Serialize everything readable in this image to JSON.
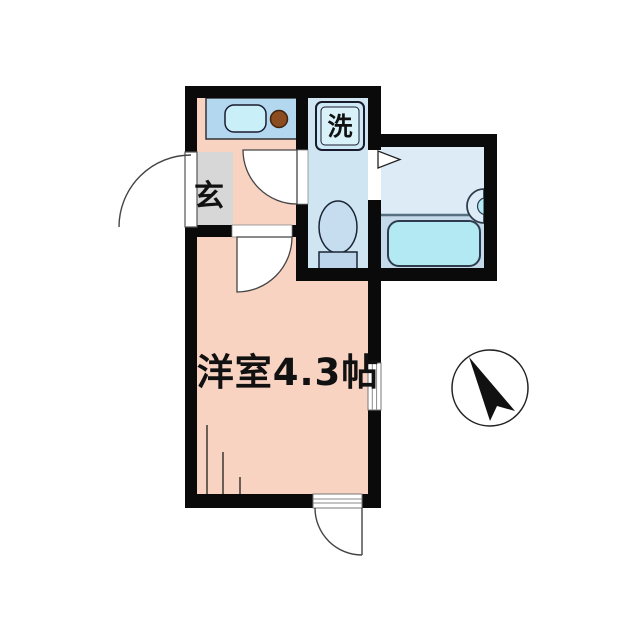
{
  "floorplan": {
    "rooms": {
      "main_room": {
        "label": "洋室4.3帖"
      },
      "genkan": {
        "label": "玄"
      },
      "laundry": {
        "label": "洗"
      }
    },
    "icons": {
      "north_arrow": "compass-north-arrow"
    },
    "colors": {
      "wall": "#0a0a0a",
      "room_pink": "#f9d3c2",
      "genkan_gray": "#d7d7d7",
      "wet_area_blue": "#cfe6f2",
      "bath_floor_light": "#dcebf5",
      "bath_floor_dark": "#c4d9e9",
      "tub_cyan": "#b2e9f3",
      "counter_blue": "#b3d7ef",
      "sink_cyan": "#c9f0f8",
      "burner_brown": "#8b4d20",
      "toilet_blue": "#c6ddf0",
      "tank_blue": "#bdd5eb",
      "pan_outer_blue": "#cdeaf6",
      "pan_inner_blue": "#d9f2fa",
      "divider_gray": "#55707e"
    }
  }
}
